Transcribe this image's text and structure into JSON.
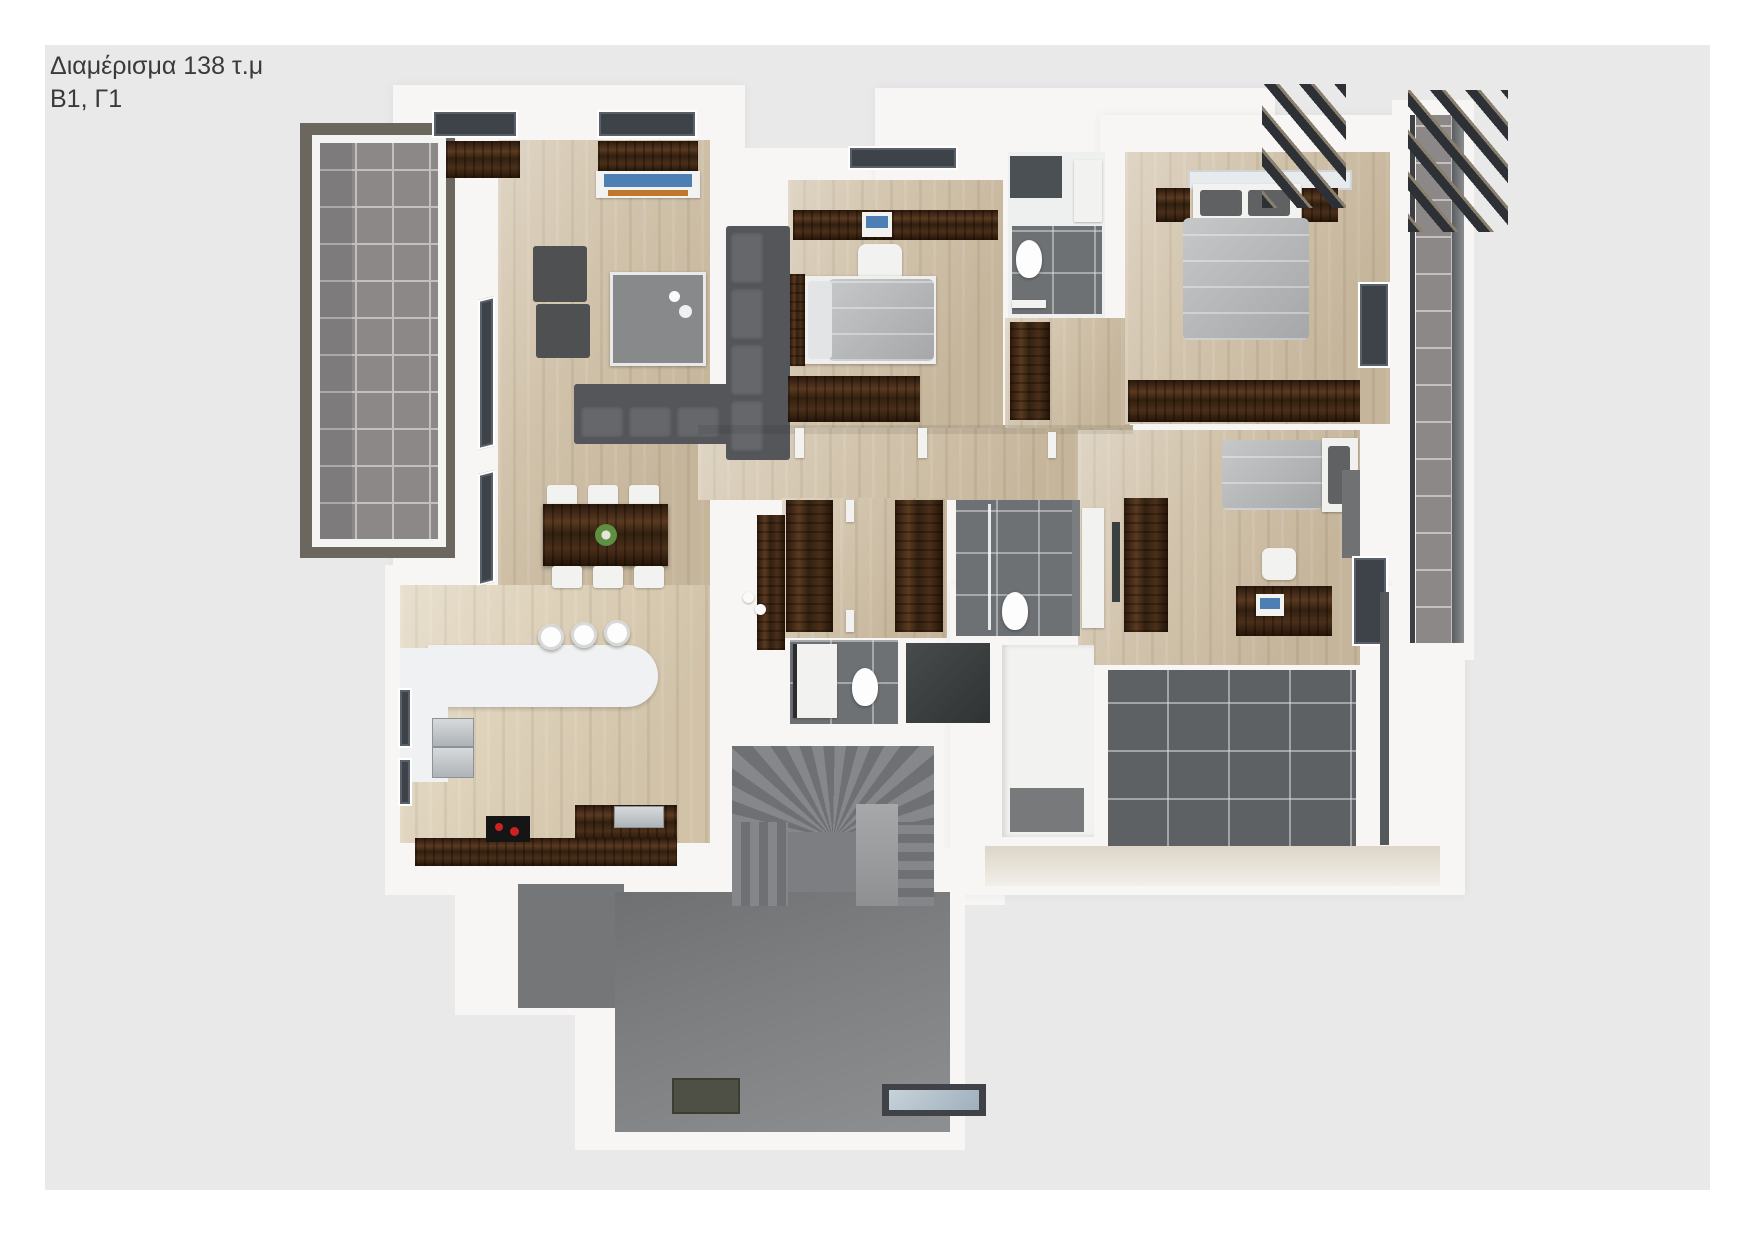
{
  "header": {
    "title": "Διαμέρισμα 138 τ.μ",
    "subtitle": "Β1, Γ1"
  },
  "page": {
    "background": "#ffffff",
    "panel_note": "light gray presentation panel behind the rendered floor plan"
  },
  "palette": {
    "panel_color": "#e9e9ea",
    "text_color": "#3a3a3a",
    "wall_white": "#f7f6f4",
    "wood_light": "#dccfb6",
    "wood_mid": "#cfc0a7",
    "tile_gray": "#8b8887",
    "tile_grid": "#c2bfbd",
    "terrace_dark": "#5d6164",
    "roof_gray": "#7f8183",
    "stair_gray": "#7c7e81",
    "balcony_frame": "#6b675e",
    "furniture_dark_gray": "#54565a",
    "wardrobe_brown": "#3f2818",
    "duvet_gray": "#b3b5b7",
    "appliance_steel": "#c3c7ca",
    "tv_blue": "#4d7fb5",
    "art_orange": "#c0762d",
    "plant_green": "#5d9040",
    "burner_red": "#cc2222",
    "pergola_dark": "#2d3136",
    "walkway_beige": "#ddd5c7"
  }
}
